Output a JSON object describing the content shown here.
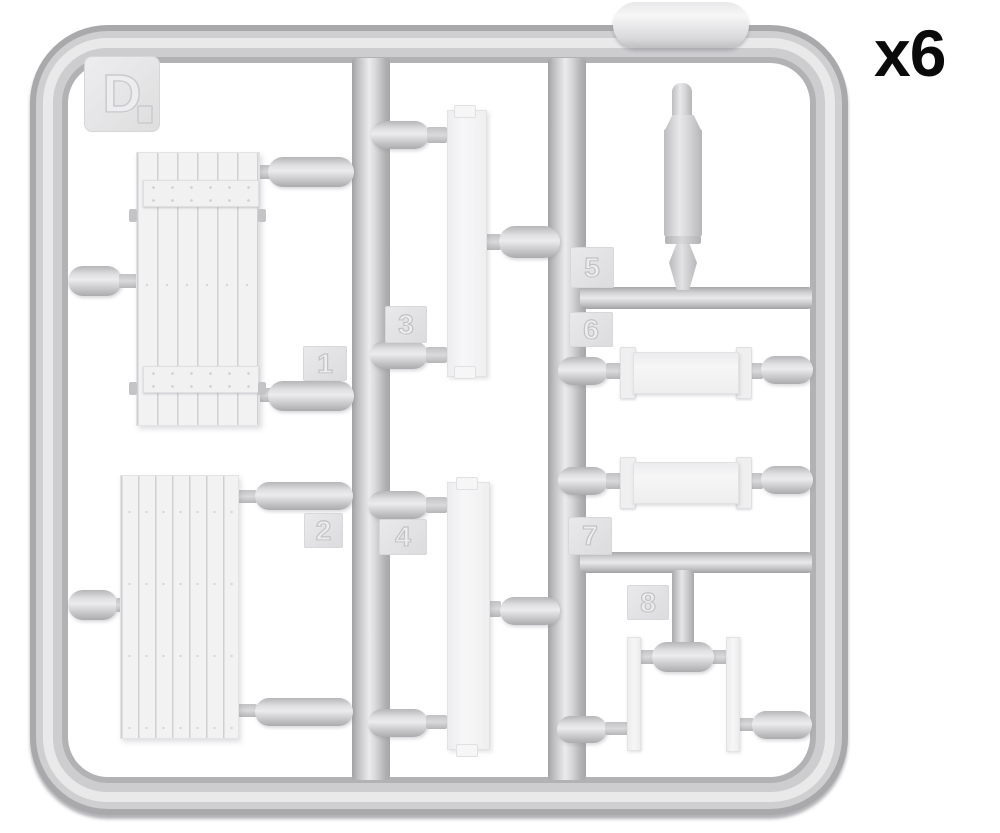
{
  "labels": {
    "quantity": "x6",
    "sprue_letter": "D"
  },
  "part_tags": [
    "1",
    "2",
    "3",
    "4",
    "5",
    "6",
    "7",
    "8"
  ],
  "palette": {
    "background": "#ffffff",
    "plastic_highlight": "#ebebed",
    "plastic_mid": "#c9c9cb",
    "plastic_shadow": "#a8a8aa",
    "part_surface": "#f3f3f4",
    "quantity_text_color": "#0a0a0a"
  },
  "parts": [
    {
      "tag": "1",
      "shape": "planked-panel-with-battens"
    },
    {
      "tag": "2",
      "shape": "planked-panel-flat"
    },
    {
      "tag": "3",
      "shape": "long-thin-board"
    },
    {
      "tag": "4",
      "shape": "long-thin-board"
    },
    {
      "tag": "5",
      "shape": "shell-canister"
    },
    {
      "tag": "6",
      "shape": "bracketed-crossbar"
    },
    {
      "tag": "7",
      "shape": "bracketed-crossbar"
    },
    {
      "tag": "8",
      "shape": "pair-of-thin-slats"
    }
  ]
}
